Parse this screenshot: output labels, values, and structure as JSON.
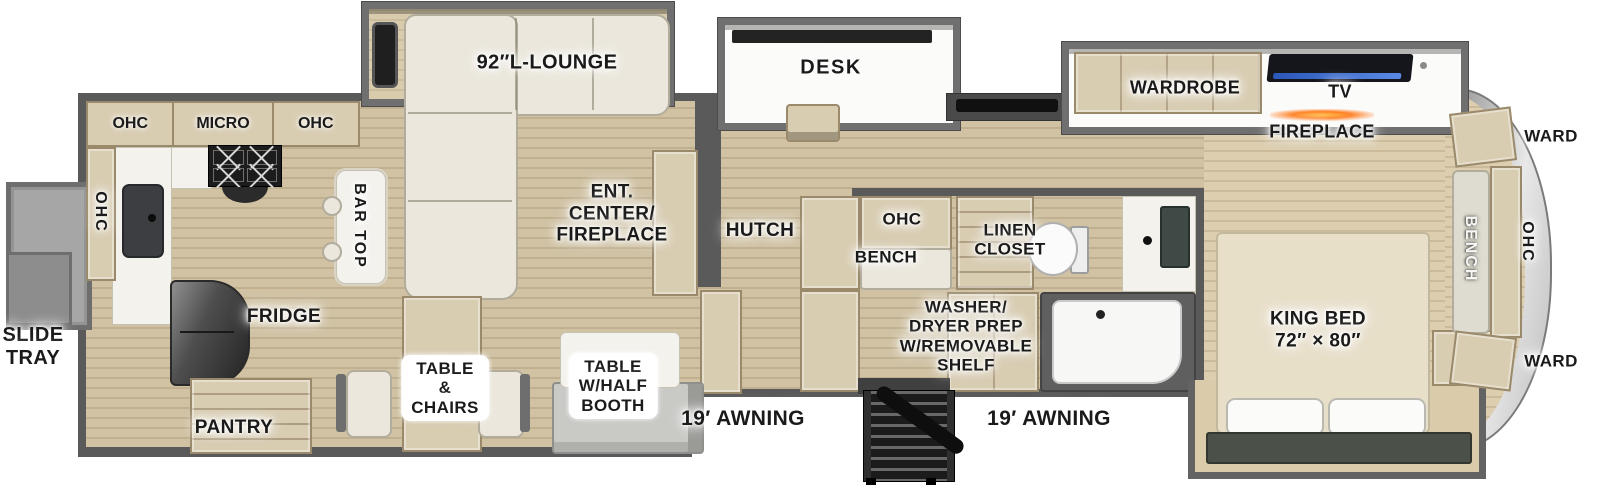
{
  "colors": {
    "floor_wood": "#cdbe9d",
    "floor_wood_light": "#dacbaa",
    "wall_gray": "#5a5a5a",
    "slide_frame_gray": "#6f6f6f",
    "cabinet_tan": "#d8ccb1",
    "cabinet_border": "#9a8a6b",
    "upholstery_cream": "#ebe7dc",
    "counter_white": "#f4f2ec",
    "appliance_dark": "#2e2e2e",
    "fireplace_orange": "#ff7d1e",
    "tv_screen_blue": "#3a67cc",
    "front_cap_silver": "#d6d6d6",
    "label_text_dark": "#1a1a1a",
    "label_text_white": "#f7f7f5"
  },
  "labels": {
    "ohc_kitchen_left": "OHC",
    "micro": "MICRO",
    "ohc_kitchen_right": "OHC",
    "ohc_kitchen_wall": "OHC",
    "bar_top": "BAR TOP",
    "lounge": "92″L-LOUNGE",
    "ent_center": "ENT.\nCENTER/\nFIREPLACE",
    "desk": "DESK",
    "hutch": "HUTCH",
    "ohc_bath": "OHC",
    "bench_bath": "BENCH",
    "linen_closet": "LINEN\nCLOSET",
    "washer_dryer": "WASHER/\nDRYER PREP\nW/REMOVABLE\nSHELF",
    "wardrobe": "WARDROBE",
    "tv": "TV",
    "fireplace": "FIREPLACE",
    "ward_top": "WARD",
    "ward_bottom": "WARD",
    "bench_front": "BENCH",
    "ohc_front": "OHC",
    "king_bed": "KING BED\n72″ × 80″",
    "slide_tray": "SLIDE\nTRAY",
    "fridge": "FRIDGE",
    "pantry": "PANTRY",
    "table_chairs": "TABLE\n&\nCHAIRS",
    "table_booth": "TABLE\nW/HALF\nBOOTH",
    "awning_left": "19′ AWNING",
    "awning_right": "19′ AWNING"
  }
}
